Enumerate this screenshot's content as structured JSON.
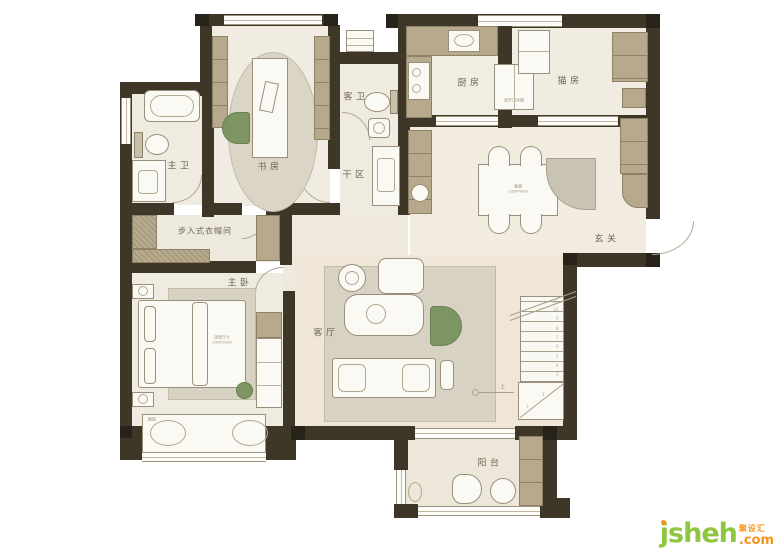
{
  "rooms": {
    "master_bath": "主卫",
    "study": "书房",
    "guest_bath": "客卫",
    "dry_area": "干区",
    "kitchen": "厨房",
    "cat_room": "猫房",
    "entry": "玄关",
    "closet": "步入式衣帽间",
    "master_bedroom": "主卧",
    "living": "客厅",
    "balcony": "阳台"
  },
  "annotations": {
    "fridge": "双开门冰箱",
    "table_name": "餐桌",
    "table_size": "(1800*900)",
    "bed_name": "床垫尺寸",
    "bed_size": "2000*2000",
    "bay_window": "飘窗",
    "up": "上"
  },
  "stairs": [
    "1",
    "2",
    "3",
    "4",
    "5",
    "6",
    "7",
    "8",
    "9",
    "10",
    "11"
  ],
  "watermark": {
    "brand": "jsheh",
    "cn": "聚设汇",
    "tld": ".com"
  },
  "colors": {
    "wall": "#3e3728",
    "floor": "#f0ebe0",
    "living_floor": "#efe6d8",
    "cabinet_tan": "#b7a98b",
    "rug_gray": "#d8d2c3",
    "accent_green": "#7d9562",
    "brand_green": "#8dc63f",
    "brand_orange": "#f6921e"
  }
}
